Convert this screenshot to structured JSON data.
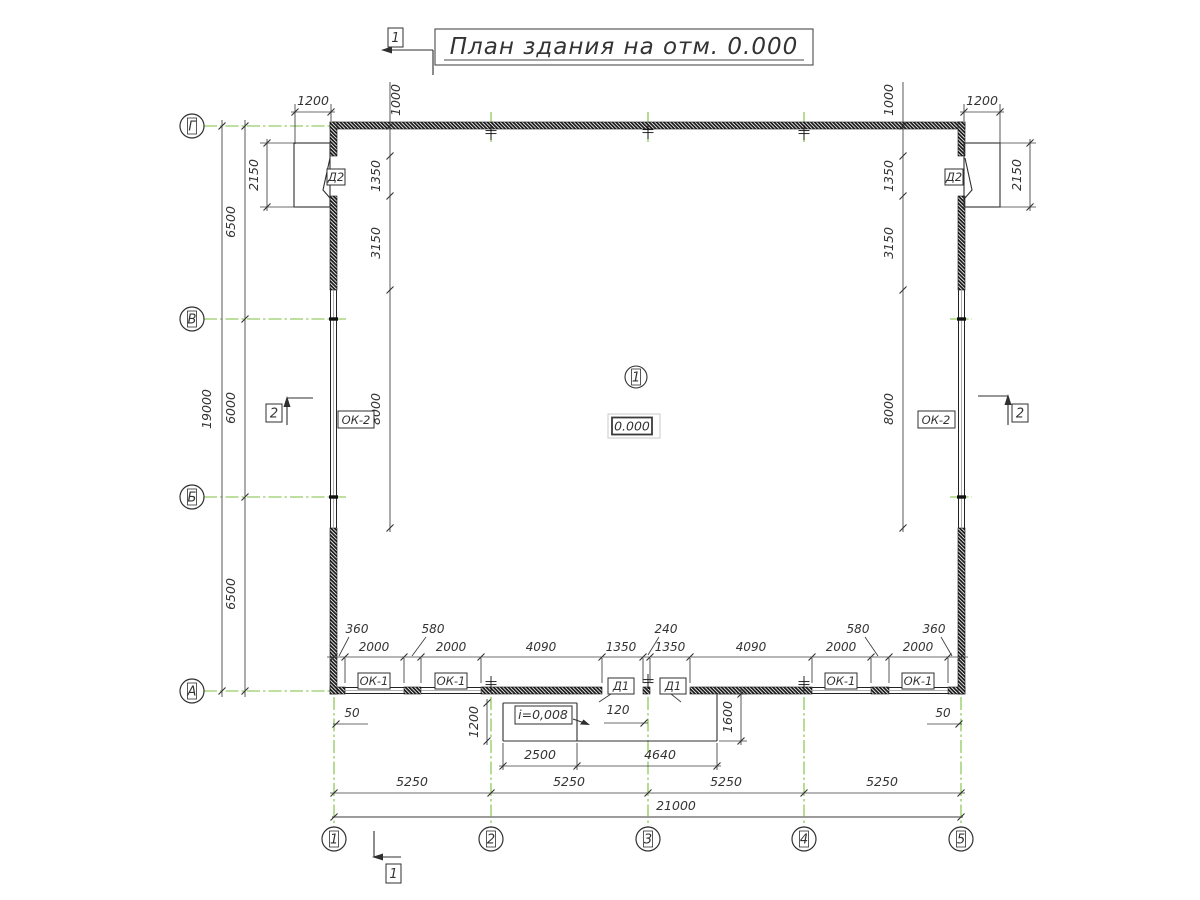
{
  "title": "План здания на отм. 0.000",
  "colors": {
    "axis_green": "#7cbf3f",
    "dim_line": "#3c3c3c",
    "wall_hatch": "#1e1e1e"
  },
  "axes": {
    "vertical": [
      "1",
      "2",
      "3",
      "4",
      "5"
    ],
    "horizontal": [
      "Г",
      "В",
      "Б",
      "А"
    ]
  },
  "room": {
    "number": "1",
    "elevation": "0.000"
  },
  "slope": {
    "label": "i=0,008"
  },
  "tags": {
    "door_d1": "Д1",
    "door_d2": "Д2",
    "window_ok1": "ОК-1",
    "window_ok2": "ОК-2"
  },
  "sections": {
    "s1": "1",
    "s2": "2"
  },
  "dims": {
    "total_w": "21000",
    "bay": "5250",
    "total_h": "19000",
    "row_a": "6500",
    "row_b": "6000",
    "top_1200": "1200",
    "top_1000": "1000",
    "door2_h": "2150",
    "side_1350": "1350",
    "side_3150": "3150",
    "side_8000": "8000",
    "b_360": "360",
    "b_580": "580",
    "b_240": "240",
    "b_2000": "2000",
    "b_4090": "4090",
    "b_1350": "1350",
    "p_50": "50",
    "p_120": "120",
    "p_1200": "1200",
    "p_1600": "1600",
    "p_2500": "2500",
    "p_4640": "4640"
  }
}
